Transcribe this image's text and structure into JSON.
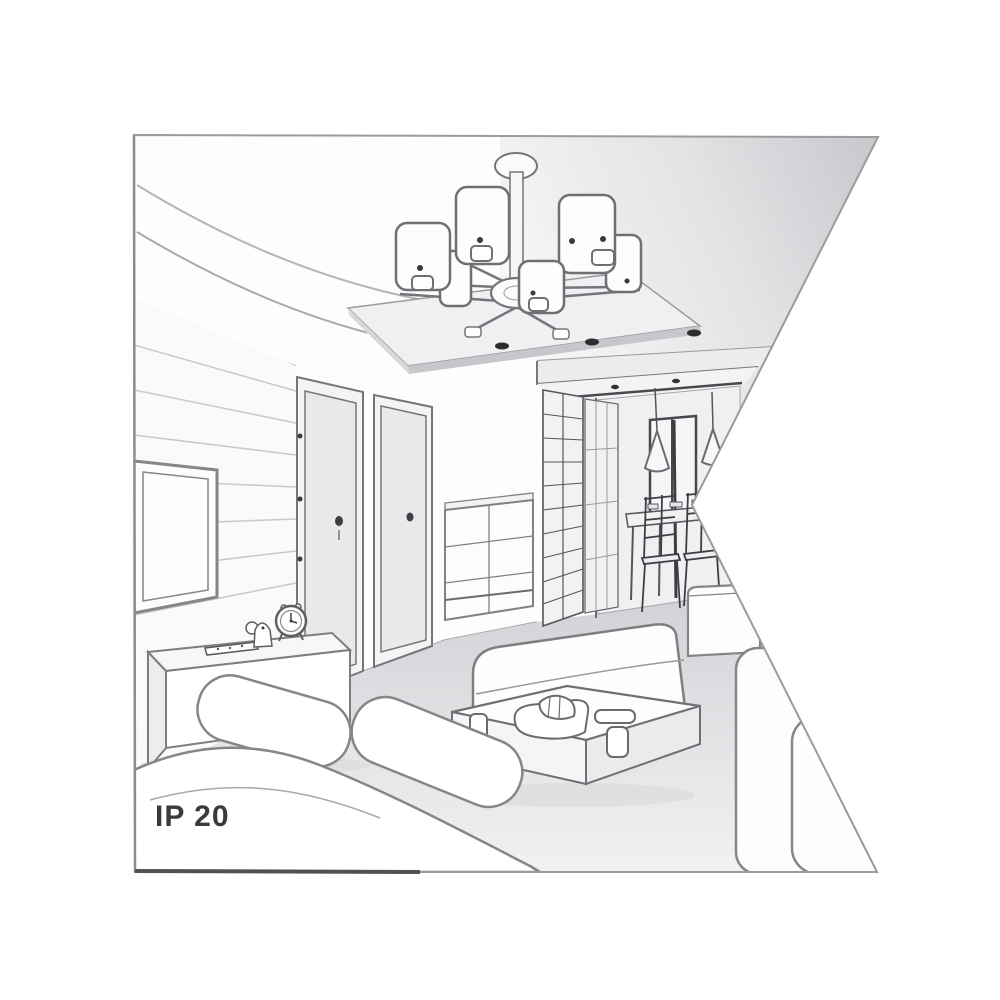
{
  "illustration": {
    "title": "Living-room interior perspective line drawing",
    "ip_rating_label": "IP 20",
    "objects": [
      "ceiling chandelier with six drum shades",
      "suspended ceiling panel",
      "recessed ceiling spotlights",
      "wall-mounted TV on slatted panel wall",
      "media console with alarm clock, figurine and remote control",
      "two interior doors",
      "chest of drawers",
      "glazed wardrobe",
      "hallway with cone pendant lights",
      "dining table with chairs",
      "back window",
      "corner sofas",
      "coffee table with cups, plate and tray"
    ],
    "colors": {
      "background": "#ffffff",
      "frame_border": "#9b9b9e",
      "frame_border_dark": "#515154",
      "line": "#76767a",
      "line_dark": "#3a3a3e",
      "fill_white": "#fdfdfe",
      "fill_light": "#f0f0f2",
      "fill_shadow": "#c7c7cb",
      "floor": "#dcdcdf",
      "label_text": "#3b3b3d"
    }
  }
}
